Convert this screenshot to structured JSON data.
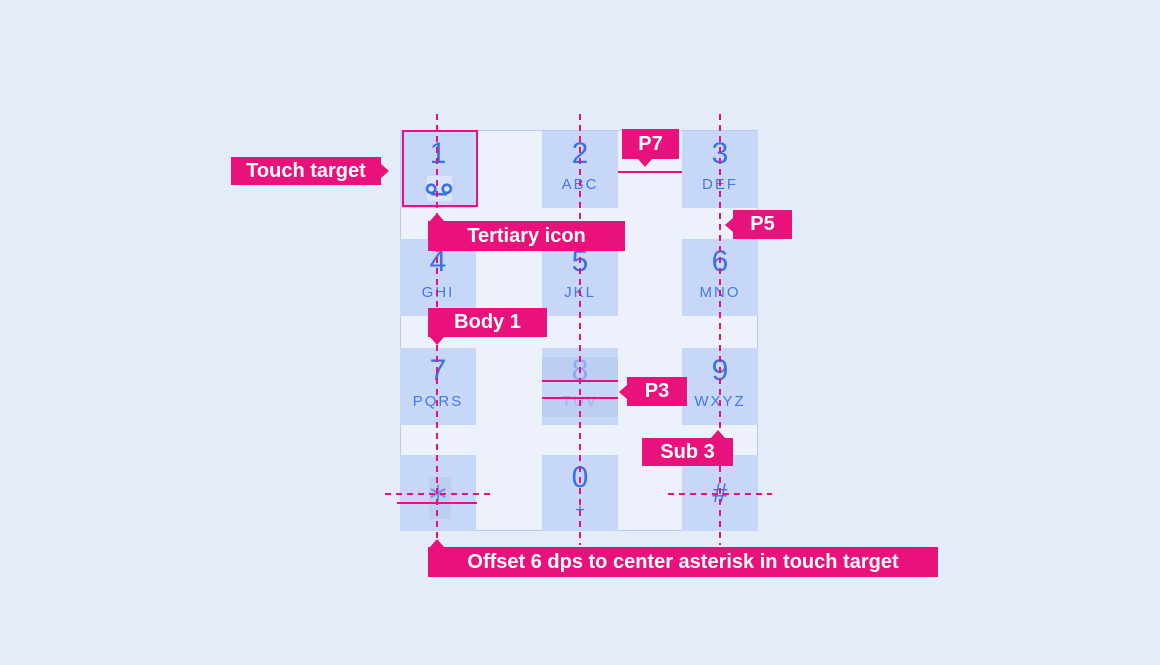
{
  "figure": {
    "description": "Dial pad touch target spec diagram"
  },
  "colors": {
    "pink": "#E9117C",
    "bg": "#E4EBF9",
    "panel": "#ECF1FC",
    "panel-border": "#B9CBEF",
    "key": "#C7D7F7",
    "num": "#3B70E3",
    "letters": "#4678E6",
    "dim-num": "#8CABEF",
    "dim-letters": "#9AB5F1",
    "band": "#BDCEF3",
    "icon-hl": "#DAE4FB",
    "asterisk": "#6D96EA",
    "label-text": "#FFFFFF"
  },
  "keypad": {
    "keys": [
      {
        "number": "1",
        "letters": "",
        "icon": "voicemail-icon"
      },
      {
        "number": "2",
        "letters": "ABC"
      },
      {
        "number": "3",
        "letters": "DEF"
      },
      {
        "number": "4",
        "letters": "GHI"
      },
      {
        "number": "5",
        "letters": "JKL"
      },
      {
        "number": "6",
        "letters": "MNO"
      },
      {
        "number": "7",
        "letters": "PQRS"
      },
      {
        "number": "8",
        "letters": "TUV"
      },
      {
        "number": "9",
        "letters": "WXYZ"
      },
      {
        "number": "*",
        "letters": "",
        "icon": "asterisk-icon"
      },
      {
        "number": "0",
        "letters": "+"
      },
      {
        "number": "#",
        "letters": ""
      }
    ]
  },
  "annotations": {
    "touch_target": "Touch target",
    "tertiary_icon": "Tertiary icon",
    "body1": "Body 1",
    "p7": "P7",
    "p5": "P5",
    "p3": "P3",
    "sub3": "Sub 3",
    "offset_note": "Offset 6 dps to center asterisk in touch target"
  }
}
